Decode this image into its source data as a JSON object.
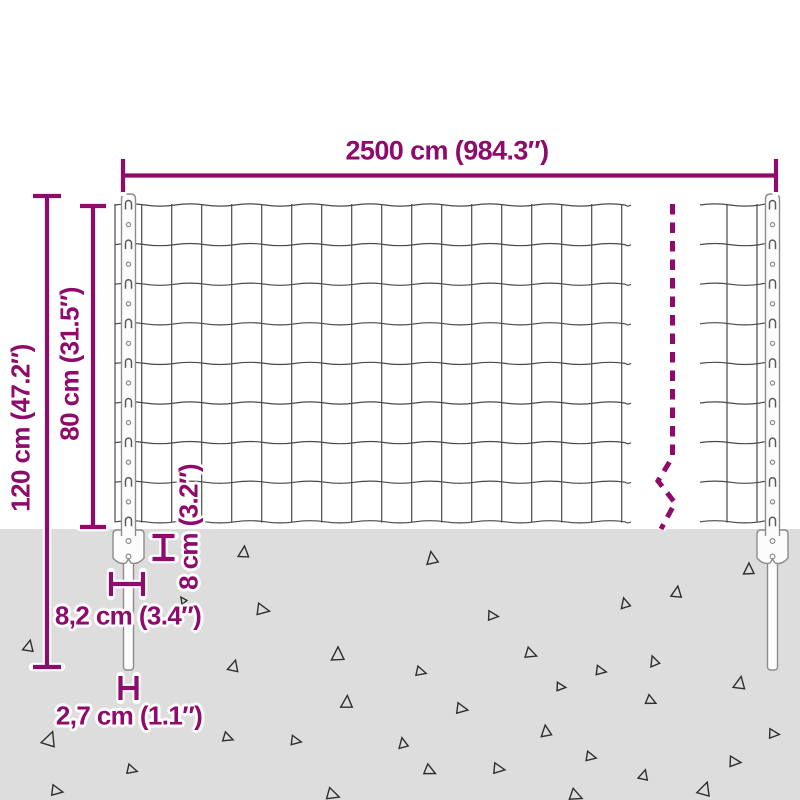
{
  "diagram": {
    "type": "product-dimension-diagram",
    "subject": "welded wire mesh fence panel with anchor posts",
    "labels": {
      "width": "2500 cm (984.3″)",
      "total_height": "120 cm (47.2″)",
      "fence_height": "80 cm (31.5″)",
      "anchor_height": "8 cm (3.2″)",
      "anchor_width": "8,2 cm (3.4″)",
      "post_thickness": "2,7 cm (1.1″)"
    },
    "colors": {
      "accent": "#8E0A6B",
      "background": "#FFFFFF",
      "ground": "#DDDDDD",
      "wire": "#4A4A4A",
      "post_fill": "#FCFCFC",
      "post_stroke": "#8C8C8C",
      "triangle": "#2E2E2E"
    },
    "geometry": {
      "ground_y": 529,
      "mesh": {
        "top": 205,
        "row_spacing": 39.6,
        "rows": 9,
        "wire_top": 204,
        "wire_bottom": 522.5,
        "left_section": {
          "x0": 115,
          "x1": 631,
          "verticals_start": 141.7,
          "vertical_spacing": 30,
          "verticals_end": 622
        },
        "right_section": {
          "x0": 700,
          "x1": 779.5,
          "verticals": [
            727,
            757
          ]
        }
      },
      "posts": [
        {
          "cx": 128.5,
          "top": 194,
          "width": 14,
          "plate_width": 31,
          "plate_top": 530,
          "plate_bottom": 564,
          "spike_width": 10,
          "spike_bottom": 670
        },
        {
          "cx": 772.5,
          "top": 194,
          "width": 14,
          "plate_width": 31,
          "plate_top": 530,
          "plate_bottom": 564,
          "spike_width": 10,
          "spike_bottom": 670
        }
      ],
      "holes": {
        "start": 224.6,
        "step": 39.6,
        "count": 8,
        "radius": 2.1
      },
      "plate_holes": [
        541,
        556.5
      ],
      "break_line": {
        "points": [
          [
            672.5,
            204
          ],
          [
            672.5,
            457
          ],
          [
            658,
            481
          ],
          [
            675,
            503
          ],
          [
            661,
            529
          ]
        ],
        "dash": "10.5 8",
        "width": 5
      },
      "markers": {
        "width": [
          [
            123,
            175.5,
            776,
            175.5
          ],
          [
            123,
            159,
            123,
            192
          ],
          [
            776,
            159,
            776,
            192
          ]
        ],
        "total_height": [
          [
            47,
            196,
            47,
            667
          ],
          [
            33,
            196,
            61,
            196
          ],
          [
            33,
            667,
            61,
            667
          ]
        ],
        "fence_height": [
          [
            93,
            206,
            93,
            527
          ],
          [
            80,
            206,
            106,
            206
          ],
          [
            80,
            527,
            106,
            527
          ]
        ],
        "anchor_height": [
          [
            163.5,
            536,
            163.5,
            559
          ],
          [
            152.5,
            536,
            174.5,
            536
          ],
          [
            152.5,
            559,
            174.5,
            559
          ]
        ],
        "anchor_width": [
          [
            111,
            584,
            143,
            584
          ],
          [
            111,
            572,
            111,
            596
          ],
          [
            143,
            572,
            143,
            596
          ]
        ],
        "post_thickness": [
          [
            120.5,
            688,
            136.5,
            688
          ],
          [
            120.5,
            676,
            120.5,
            700
          ],
          [
            136.5,
            676,
            136.5,
            700
          ]
        ]
      },
      "triangles": [
        [
          244,
          552,
          10,
          5
        ],
        [
          432,
          558,
          11,
          -10
        ],
        [
          749,
          569,
          10,
          0
        ],
        [
          263,
          610,
          11,
          100
        ],
        [
          493,
          616,
          9,
          95
        ],
        [
          677,
          592,
          10,
          8
        ],
        [
          625,
          603,
          9,
          -15
        ],
        [
          29,
          646,
          10,
          12
        ],
        [
          338,
          654,
          12,
          0
        ],
        [
          531,
          654,
          10,
          110
        ],
        [
          234,
          666,
          10,
          15
        ],
        [
          421,
          672,
          9,
          105
        ],
        [
          601,
          671,
          9,
          100
        ],
        [
          561,
          687,
          8,
          95
        ],
        [
          654,
          661,
          9,
          -20
        ],
        [
          740,
          683,
          11,
          10
        ],
        [
          347,
          702,
          11,
          3
        ],
        [
          462,
          709,
          10,
          100
        ],
        [
          651,
          701,
          9,
          115
        ],
        [
          546,
          731,
          10,
          -8
        ],
        [
          50,
          739,
          13,
          20
        ],
        [
          228,
          738,
          9,
          110
        ],
        [
          296,
          741,
          9,
          100
        ],
        [
          403,
          743,
          9,
          -12
        ],
        [
          774,
          734,
          9,
          95
        ],
        [
          132,
          770,
          9,
          105
        ],
        [
          430,
          771,
          10,
          115
        ],
        [
          499,
          769,
          10,
          98
        ],
        [
          57,
          791,
          10,
          100
        ],
        [
          333,
          795,
          11,
          108
        ],
        [
          576,
          796,
          11,
          112
        ],
        [
          644,
          775,
          9,
          15
        ],
        [
          705,
          789,
          12,
          18
        ],
        [
          591,
          757,
          9,
          102
        ],
        [
          735,
          762,
          10,
          95
        ],
        [
          183,
          600,
          6,
          -35
        ]
      ]
    }
  }
}
